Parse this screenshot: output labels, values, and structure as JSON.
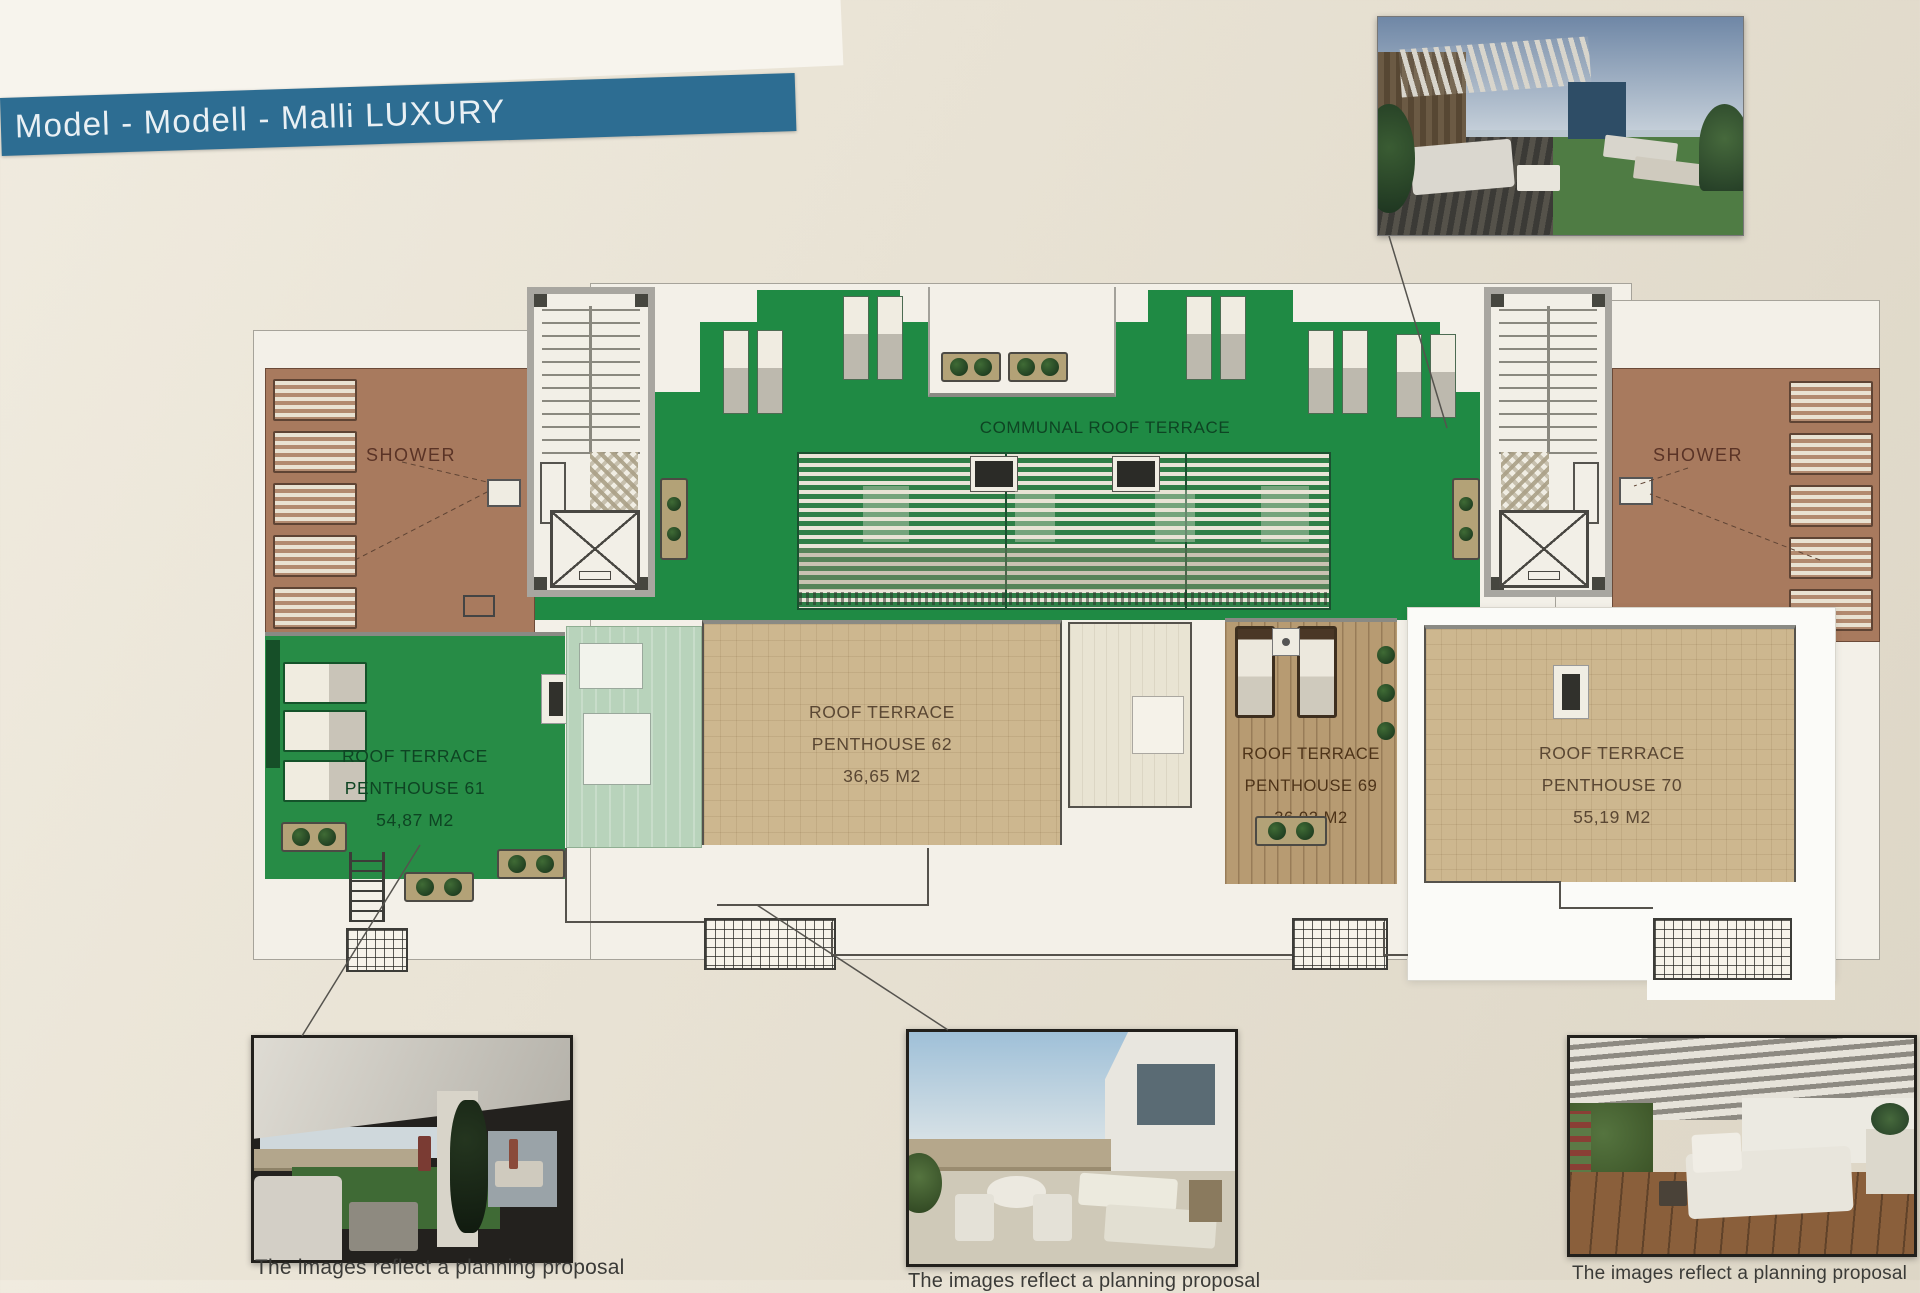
{
  "banner": {
    "text": "Model - Modell - Malli  LUXURY"
  },
  "plan": {
    "communal_label": "COMMUNAL ROOF TERRACE",
    "shower_left_label": "SHOWER",
    "shower_right_label": "SHOWER",
    "penthouses": [
      {
        "line1": "ROOF TERRACE",
        "line2": "PENTHOUSE 61",
        "area": "54,87 M2"
      },
      {
        "line1": "ROOF TERRACE",
        "line2": "PENTHOUSE 62",
        "area": "36,65 M2"
      },
      {
        "line1": "ROOF TERRACE",
        "line2": "PENTHOUSE 69",
        "area": "36,02 M2"
      },
      {
        "line1": "ROOF TERRACE",
        "line2": "PENTHOUSE 70",
        "area": "55,19 M2"
      }
    ]
  },
  "captions": {
    "left": "The images reflect a planning proposal",
    "middle": "The images reflect a planning proposal",
    "right": "The images reflect a planning proposal"
  },
  "colors": {
    "banner_bg": "#2d6d92",
    "communal_green": "#1f8a44",
    "penthouse61_green": "#278c46",
    "terrace_brown": "#a87a5e",
    "tile_tan": "#cdb78f",
    "wood_deck": "#b79b72",
    "mint_skylight": "#b8d3bb",
    "highlight_box": "#fbfbf8"
  }
}
